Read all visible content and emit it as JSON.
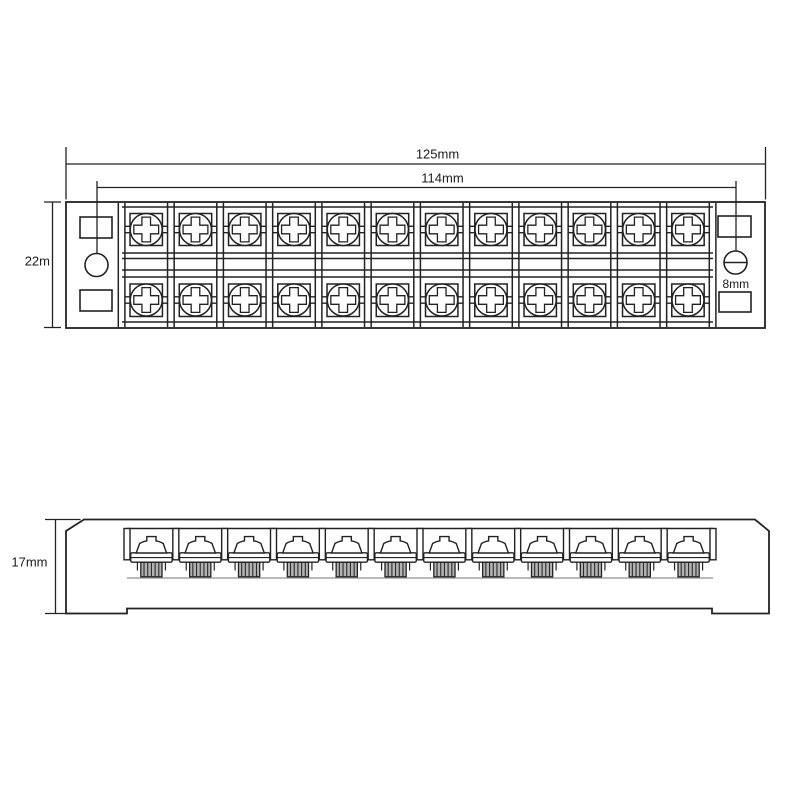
{
  "figure": {
    "type": "technical-drawing",
    "background": "#ffffff",
    "line_color": "#222222"
  },
  "top_view": {
    "terminal_columns": 12,
    "terminal_rows": 2,
    "labels": {
      "overall_width": "125mm",
      "screw_spacing": "114mm",
      "body_depth": "22m",
      "end_screw": "8mm"
    }
  },
  "side_view": {
    "screw_count": 12,
    "labels": {
      "height": "17mm"
    }
  }
}
